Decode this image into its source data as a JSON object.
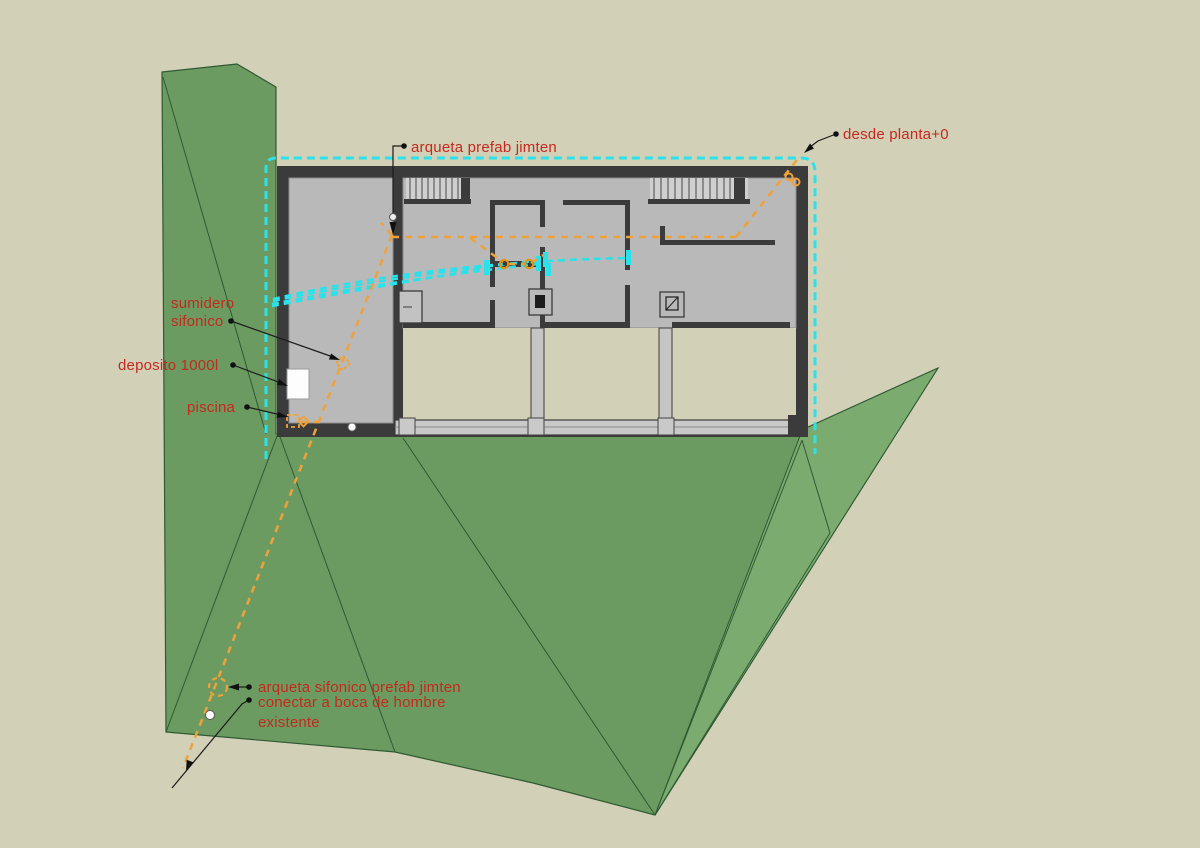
{
  "drawing": {
    "type": "sketchup-plan-drainage-scheme",
    "labels": {
      "arqueta_prefab": "arqueta prefab jimten",
      "desde_planta": "desde planta+0",
      "sumidero_line1": "sumidero",
      "sumidero_line2": "sifonico",
      "deposito": "deposito 1000l",
      "piscina": "piscina",
      "arqueta_sifonico": "arqueta sifonico prefab jimten",
      "conectar_line1": "conectar a boca de hombre",
      "conectar_line2": "existente"
    },
    "colors": {
      "label_red": "#c5291d",
      "pipe_orange": "#f0a23a",
      "drain_cyan": "#2be2ea",
      "terrain_green": "#6b9b61",
      "terrain_green_light": "#7cab6f",
      "terrain_edge": "#2f5a33",
      "wall_dark": "#3b3b3b",
      "floor_gray": "#b9b9b9",
      "ground_beige": "#d3d0b8",
      "glazing_gray": "#c9c9c9"
    }
  }
}
